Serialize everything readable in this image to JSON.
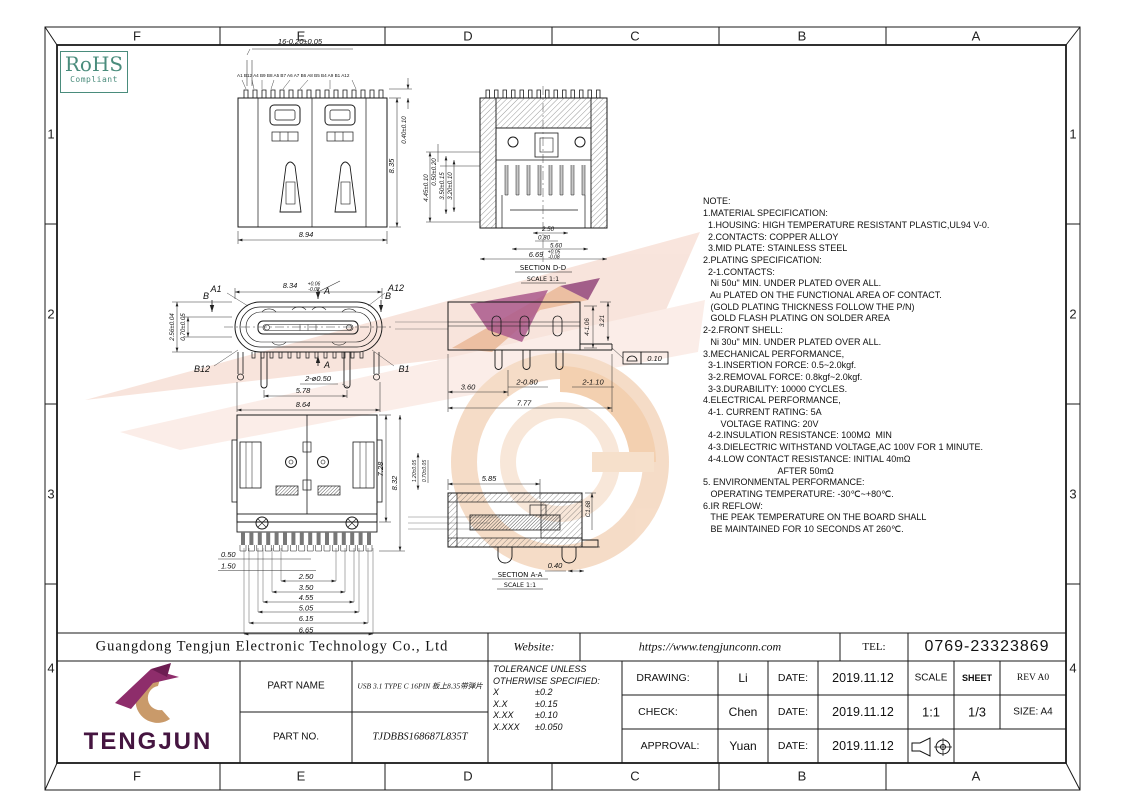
{
  "grid": {
    "cols": [
      "F",
      "E",
      "D",
      "C",
      "B",
      "A"
    ],
    "rows": [
      "1",
      "2",
      "3",
      "4"
    ]
  },
  "rohs": {
    "line1": "RoHS",
    "line2": "Compliant"
  },
  "notes": {
    "lines": [
      "NOTE:",
      "1.MATERIAL SPECIFICATION:",
      "  1.HOUSING: HIGH TEMPERATURE RESISTANT PLASTIC,UL94 V-0.",
      "  2.CONTACTS: COPPER ALLOY",
      "  3.MID PLATE: STAINLESS STEEL",
      "2.PLATING SPECIFICATION:",
      "  2-1.CONTACTS:",
      "   Ni 50u\" MIN. UNDER PLATED OVER ALL.",
      "   Au PLATED ON THE FUNCTIONAL AREA OF CONTACT.",
      "   (GOLD PLATING THICKNESS FOLLOW THE P/N)",
      "   GOLD FLASH PLATING ON SOLDER AREA",
      "2-2.FRONT SHELL:",
      "   Ni 30u\" MIN. UNDER PLATED OVER ALL.",
      "3.MECHANICAL PERFORMANCE,",
      "  3-1.INSERTION FORCE: 0.5~2.0kgf.",
      "  3-2.REMOVAL FORCE: 0.8kgf~2.0kgf.",
      "  3-3.DURABILITY: 10000 CYCLES.",
      "4.ELECTRICAL PERFORMANCE,",
      "  4-1. CURRENT RATING: 5A",
      "       VOLTAGE RATING: 20V",
      "  4-2.INSULATION RESISTANCE: 100MΩ  MIN",
      "  4-3.DIELECTRIC WITHSTAND VOLTAGE,AC 100V FOR 1 MINUTE.",
      "  4-4.LOW CONTACT RESISTANCE: INITIAL 40mΩ",
      "                              AFTER 50mΩ",
      "5. ENVIRONMENTAL PERFORMANCE:",
      "   OPERATING TEMPERATURE: -30℃~+80℃.",
      "6.IR REFLOW:",
      "   THE PEAK TEMPERATURE ON THE BOARD SHALL",
      "   BE MAINTAINED FOR 10 SECONDS AT 260℃."
    ]
  },
  "views": {
    "v1": {
      "dim_pins": "16-0.20±0.05",
      "pin_labels": "A1 B12 A4 B9 B8 A5 B7 A6 A7 B6 A8 B5 B4 A9 B1 A12",
      "w": "8.94",
      "h": "8.35",
      "pin_h": "0.40±0.10"
    },
    "v2": {
      "label": "SECTION D-D",
      "scale": "SCALE 1:1",
      "d1": "4.45±0.10",
      "d2": "0.50±0.20",
      "d3": "3.50±0.15",
      "d4": "3.20±0.10",
      "b1": "2.50",
      "b2": "0.80",
      "b3": "5.60",
      "b4": "6.69",
      "b4t1": "+0.05",
      "b4t2": "-0.08"
    },
    "v3": {
      "a1": "A1",
      "a12": "A12",
      "b12": "B12",
      "b1": "B1",
      "secA": "A",
      "secB": "B",
      "top": "8.34",
      "topt1": "+0.06",
      "topt2": "-0.02",
      "l1": "2.56±0.04",
      "l2": "0.70±0.05",
      "hole": "2-ø0.50",
      "p1": "5.78",
      "p2": "8.64"
    },
    "v4": {
      "d1": "3.60",
      "d2": "7.77",
      "d3": "2-0.80",
      "d4": "2-1.10",
      "r1": "4-1.06",
      "r2": "3.21",
      "gdt": "0.10"
    },
    "v5": {
      "r1": "7.28",
      "r2": "8.32",
      "r3": "1.20±0.05",
      "r4": "0.70±0.05",
      "c1": "0.50",
      "c2": "1.50",
      "c3": "2.50",
      "c4": "3.50",
      "c5": "4.55",
      "c6": "5.05",
      "c7": "6.15",
      "c8": "6.65"
    },
    "v6": {
      "label": "SECTION A-A",
      "scale": "SCALE 1:1",
      "t": "5.85",
      "r": "C1.68",
      "b": "0.40"
    }
  },
  "title_block": {
    "company": "Guangdong Tengjun Electronic Technology Co., Ltd",
    "website_label": "Website:",
    "website": "https://www.tengjunconn.com",
    "tel_label": "TEL:",
    "tel": "0769-23323869",
    "logo_text": "TENGJUN",
    "part_name_label": "PART NAME",
    "part_name": "USB 3.1 TYPE C 16PIN 板上8.35带弹片",
    "part_no_label": "PART NO.",
    "part_no": "TJDBBS168687L835T",
    "tol_line1": "TOLERANCE UNLESS",
    "tol_line2": "OTHERWISE SPECIFIED:",
    "tol_x_label": "X",
    "tol_x": "±0.2",
    "tol_xx_label": "X.X",
    "tol_xx": "±0.15",
    "tol_xxx_label": "X.XX",
    "tol_xxx": "±0.10",
    "tol_xxxx_label": "X.XXX",
    "tol_xxxx": "±0.050",
    "drawing_label": "DRAWING:",
    "drawing_name": "Li",
    "drawing_date_label": "DATE:",
    "drawing_date": "2019.11.12",
    "check_label": "CHECK:",
    "check_name": "Chen",
    "check_date_label": "DATE:",
    "check_date": "2019.11.12",
    "approval_label": "APPROVAL:",
    "approval_name": "Yuan",
    "approval_date_label": "DATE:",
    "approval_date": "2019.11.12",
    "scale_label": "SCALE",
    "scale_value": "1:1",
    "sheet_label": "SHEET",
    "sheet_value": "1/3",
    "rev": "REV A0",
    "size": "SIZE: A4"
  },
  "colors": {
    "rohs_green": "#4a8c7c",
    "logo_purple": "#8e2d6b",
    "logo_gold": "#c99a6a",
    "logo_text_purple": "#451540",
    "watermark_pink": "#f8e2d9",
    "watermark_orange": "#f2cba8",
    "watermark_purple": "#a2487f"
  }
}
